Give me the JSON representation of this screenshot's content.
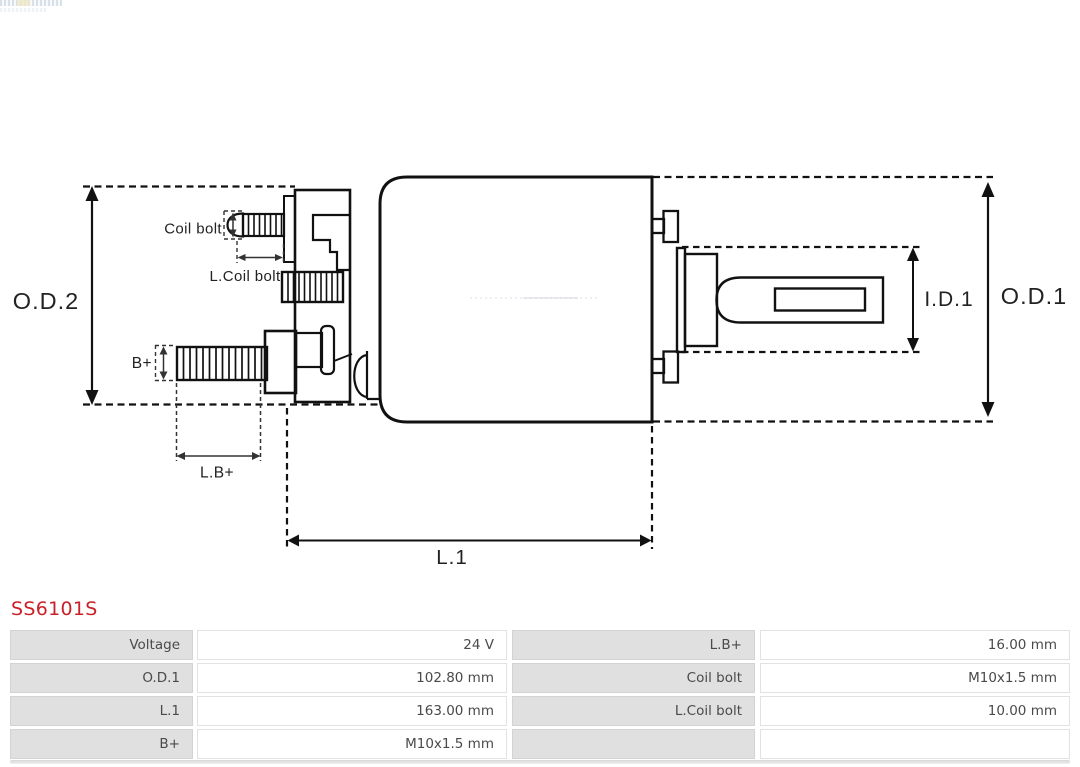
{
  "part_number": "SS6101S",
  "diagram": {
    "labels": {
      "od2": "O.D.2",
      "coil_bolt": "Coil bolt",
      "l_coil_bolt": "L.Coil bolt",
      "b_plus": "B+",
      "l_b_plus": "L.B+",
      "l1": "L.1",
      "id1": "I.D.1",
      "od1": "O.D.1"
    }
  },
  "table": {
    "rows": [
      {
        "label1": "Voltage",
        "value1": "24 V",
        "label2": "L.B+",
        "value2": "16.00 mm"
      },
      {
        "label1": "O.D.1",
        "value1": "102.80 mm",
        "label2": "Coil bolt",
        "value2": "M10x1.5 mm"
      },
      {
        "label1": "L.1",
        "value1": "163.00 mm",
        "label2": "L.Coil bolt",
        "value2": "10.00 mm"
      },
      {
        "label1": "B+",
        "value1": "M10x1.5 mm",
        "label2": "",
        "value2": ""
      }
    ]
  },
  "colors": {
    "part_number_red": "#c92127",
    "drawing_line": "#111111",
    "table_label_bg": "#e0e0e0",
    "table_text": "#4a4a4a"
  }
}
